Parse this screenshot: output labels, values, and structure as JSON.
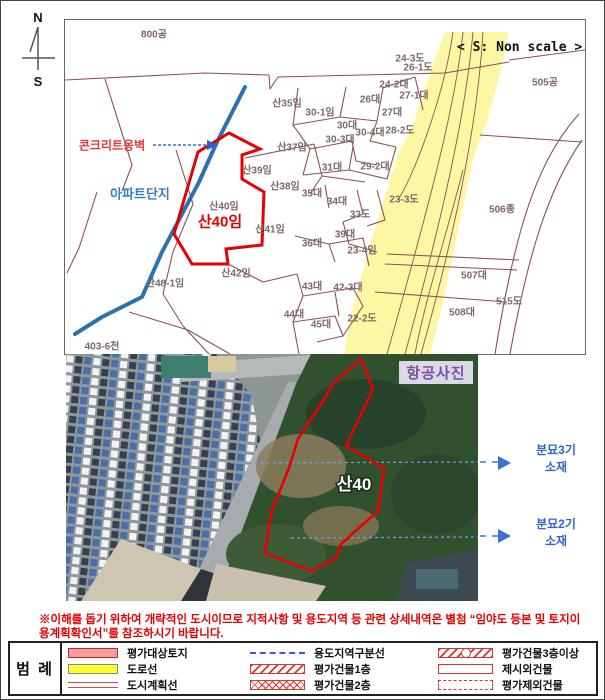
{
  "page": {
    "scale_note": "< S: Non scale >",
    "compass_n": "N",
    "compass_s": "S"
  },
  "map": {
    "parcel_labels": [
      {
        "text": "800공",
        "x": 89,
        "y": 13
      },
      {
        "text": "산35임",
        "x": 222,
        "y": 82
      },
      {
        "text": "30-1임",
        "x": 255,
        "y": 91
      },
      {
        "text": "30대",
        "x": 282,
        "y": 104
      },
      {
        "text": "30-3대",
        "x": 275,
        "y": 118
      },
      {
        "text": "30-4대",
        "x": 305,
        "y": 111
      },
      {
        "text": "26대",
        "x": 305,
        "y": 78
      },
      {
        "text": "24-2대",
        "x": 329,
        "y": 63
      },
      {
        "text": "27-1대",
        "x": 349,
        "y": 74
      },
      {
        "text": "27대",
        "x": 327,
        "y": 91
      },
      {
        "text": "28-2도",
        "x": 335,
        "y": 109
      },
      {
        "text": "31대",
        "x": 267,
        "y": 146
      },
      {
        "text": "29-2대",
        "x": 310,
        "y": 145
      },
      {
        "text": "24-3도",
        "x": 345,
        "y": 37
      },
      {
        "text": "26-1도",
        "x": 353,
        "y": 46
      },
      {
        "text": "505공",
        "x": 480,
        "y": 61
      },
      {
        "text": "23-3도",
        "x": 339,
        "y": 178
      },
      {
        "text": "506종",
        "x": 437,
        "y": 188
      },
      {
        "text": "507대",
        "x": 409,
        "y": 254
      },
      {
        "text": "515도",
        "x": 444,
        "y": 280
      },
      {
        "text": "508대",
        "x": 397,
        "y": 291
      },
      {
        "text": "산37임",
        "x": 227,
        "y": 126
      },
      {
        "text": "산39임",
        "x": 192,
        "y": 149
      },
      {
        "text": "산38임",
        "x": 220,
        "y": 165
      },
      {
        "text": "35대",
        "x": 247,
        "y": 172
      },
      {
        "text": "34대",
        "x": 272,
        "y": 180
      },
      {
        "text": "33도",
        "x": 295,
        "y": 193
      },
      {
        "text": "39대",
        "x": 280,
        "y": 213
      },
      {
        "text": "23-4임",
        "x": 297,
        "y": 229
      },
      {
        "text": "산40임",
        "x": 159,
        "y": 185
      },
      {
        "text": "산41임",
        "x": 205,
        "y": 208
      },
      {
        "text": "36대",
        "x": 247,
        "y": 222
      },
      {
        "text": "산42임",
        "x": 171,
        "y": 252
      },
      {
        "text": "43대",
        "x": 247,
        "y": 265
      },
      {
        "text": "42-3대",
        "x": 283,
        "y": 266
      },
      {
        "text": "44대",
        "x": 229,
        "y": 293
      },
      {
        "text": "45대",
        "x": 256,
        "y": 303
      },
      {
        "text": "22-2도",
        "x": 297,
        "y": 297
      },
      {
        "text": "산48-1임",
        "x": 100,
        "y": 262
      },
      {
        "text": "403-6천",
        "x": 37,
        "y": 325
      }
    ],
    "subject_parcel_label": "산40임",
    "wall_callout": "콘크리트옹벽",
    "apartment_label": "아파트단지"
  },
  "aerial": {
    "title": "항공사진",
    "parcel_label": "산40",
    "callouts": [
      {
        "title": "분묘3기",
        "sub": "소재"
      },
      {
        "title": "분묘2기",
        "sub": "소재"
      }
    ]
  },
  "notice": "※이해를 돕기 위하여 개략적인 도시이므로 지적사항 및 용도지역 등 관련 상세내역은 별첨 “임야도 등본 및 토지이용계획확인서”를 참조하시기 바랍니다.",
  "legend": {
    "title": "범 례",
    "items": [
      {
        "label": "평가대상토지",
        "swatch": "subject"
      },
      {
        "label": "도로선",
        "swatch": "road"
      },
      {
        "label": "도시계획선",
        "swatch": "cityplan"
      },
      {
        "label": "용도지역구분선",
        "swatch": "zoneline"
      },
      {
        "label": "평가건물1층",
        "swatch": "hatch1"
      },
      {
        "label": "평가건물2층",
        "swatch": "hatch2"
      },
      {
        "label": "평가건물3층이상",
        "swatch": "hatch3"
      },
      {
        "label": "제시외건물",
        "swatch": "outline"
      },
      {
        "label": "평가제외건물",
        "swatch": "dashed-outline"
      }
    ]
  },
  "colors": {
    "subject_outline": "#e60000",
    "road_fill": "#fdf6a3",
    "river": "#2a72b5",
    "boundary": "#8a5252",
    "callout_blue": "#2f66cc",
    "notice_red": "#e60000"
  }
}
